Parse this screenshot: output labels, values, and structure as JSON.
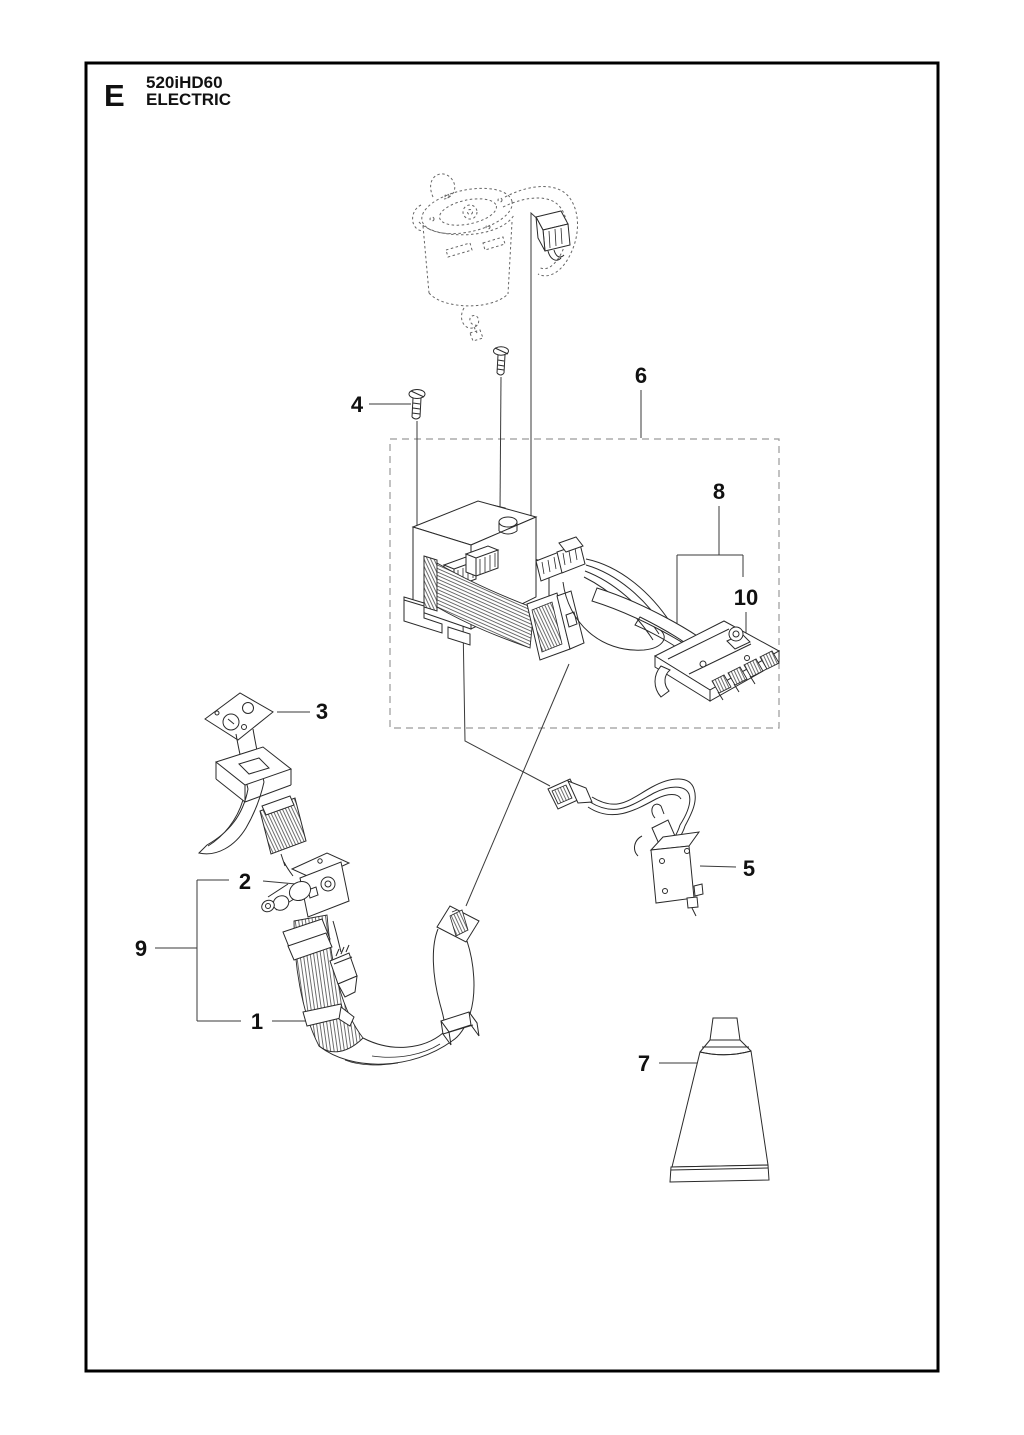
{
  "header": {
    "section_letter": "E",
    "model": "520iHD60",
    "section_title": "ELECTRIC"
  },
  "callouts": {
    "n1": "1",
    "n2": "2",
    "n3": "3",
    "n4": "4",
    "n5": "5",
    "n6": "6",
    "n7": "7",
    "n8": "8",
    "n9": "9",
    "n10": "10"
  },
  "colors": {
    "background": "#ffffff",
    "frame": "#000000",
    "line_art": "#2a2a2a",
    "phantom_line": "#666666",
    "leader_line": "#3a3a3a",
    "group_box_dashed": "#9a9a9a"
  },
  "figure": {
    "type": "exploded-parts-diagram",
    "callout_count": 10
  }
}
